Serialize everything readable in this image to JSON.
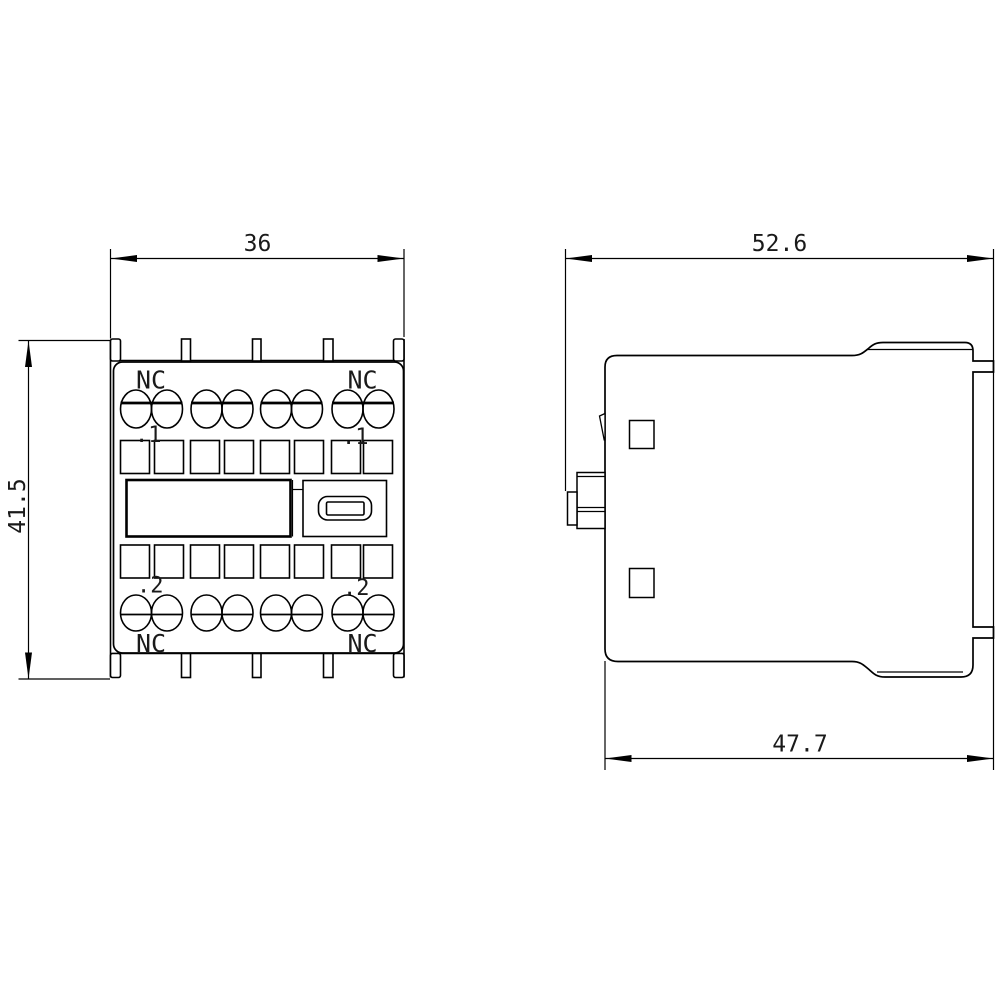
{
  "drawing": {
    "type": "technical-dimension-drawing",
    "colors": {
      "background": "#ffffff",
      "line": "#000000",
      "text": "#1a1a1a"
    },
    "dimensions": {
      "front_width": "36",
      "front_height": "41.5",
      "side_depth_total": "52.6",
      "side_depth_lower": "47.7"
    },
    "front_view": {
      "nc_top_left": "NC",
      "nc_top_right": "NC",
      "nc_bottom_left": "NC",
      "nc_bottom_right": "NC",
      "terminal_mark_top_left": ".1",
      "terminal_mark_top_right": ".1",
      "terminal_mark_bottom_left": ".2",
      "terminal_mark_bottom_right": ".2"
    }
  }
}
